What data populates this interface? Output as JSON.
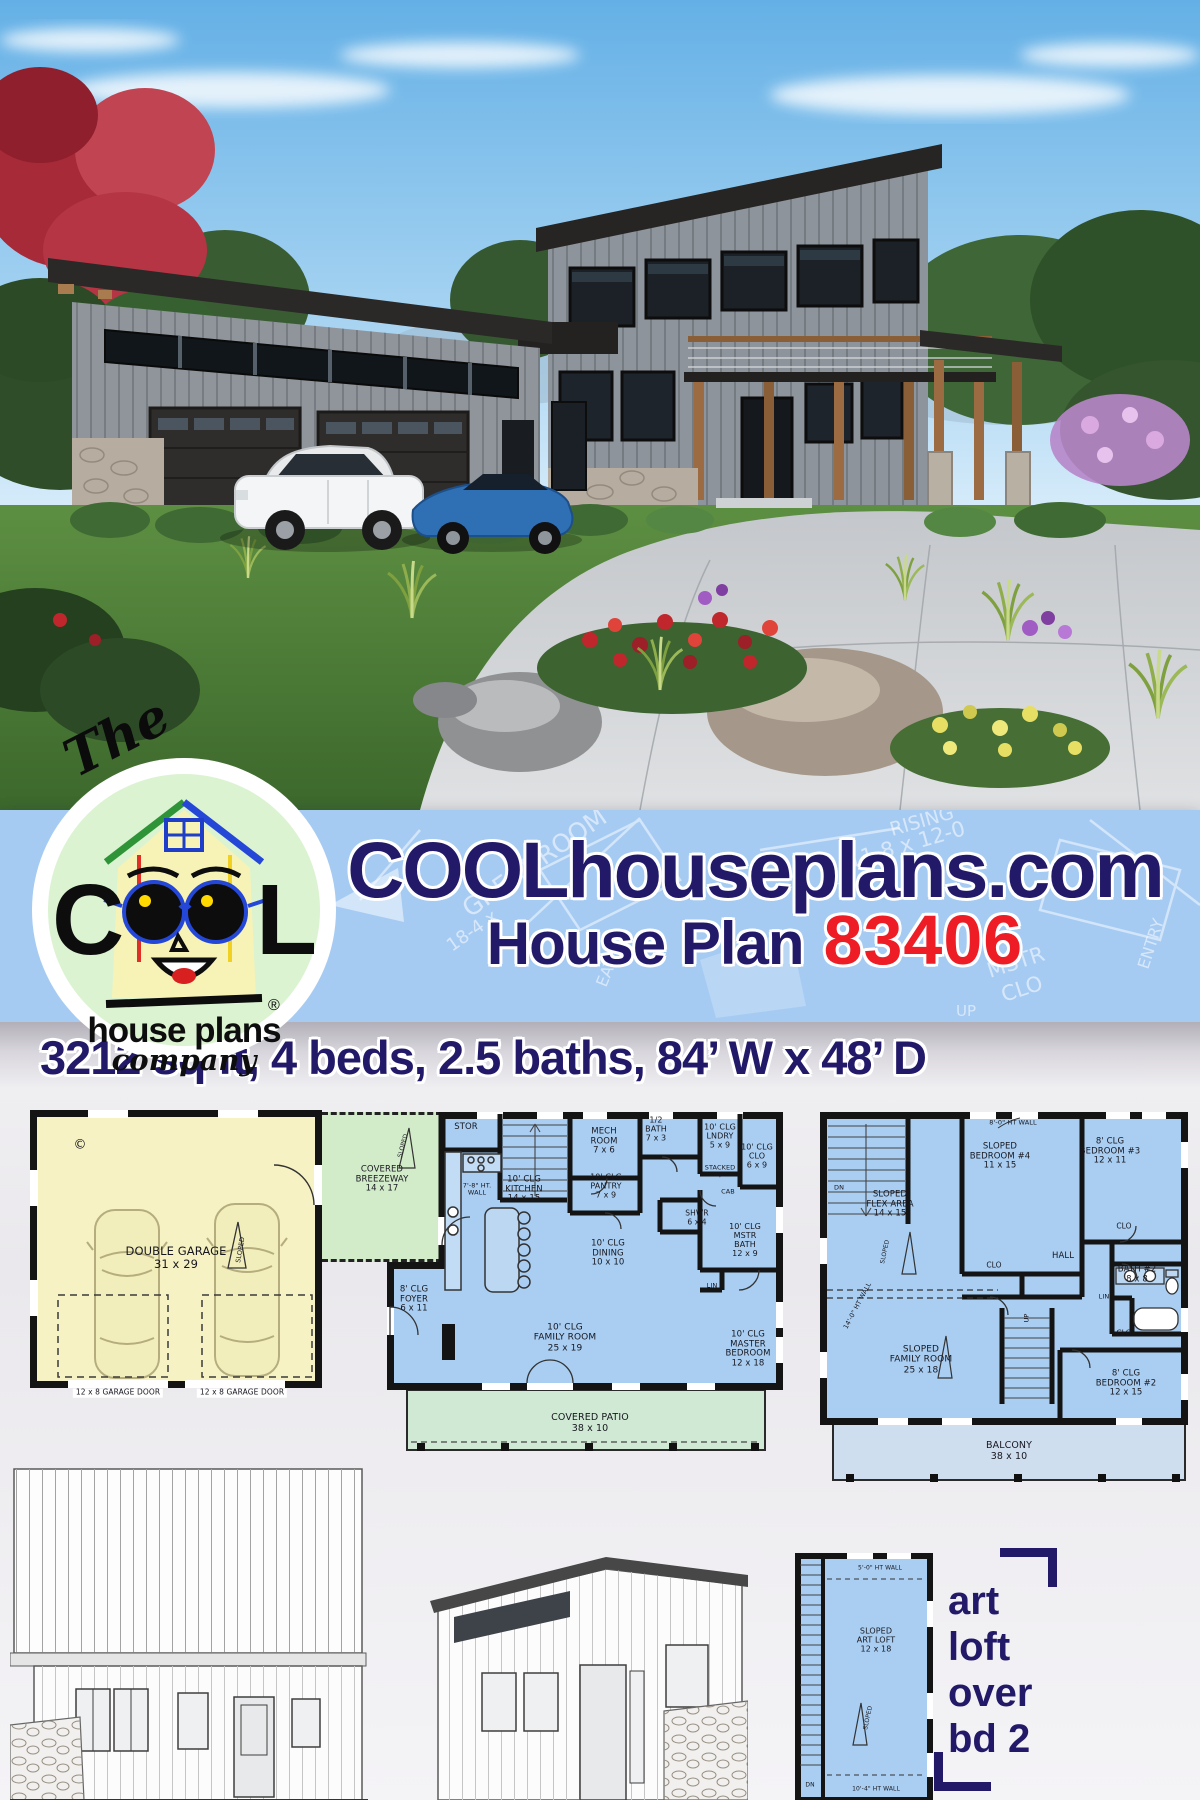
{
  "brand": {
    "the": "The",
    "c": "C",
    "l": "L",
    "house_plans": "house plans",
    "company": "company",
    "reg": "®"
  },
  "header": {
    "site": "COOLhouseplans.com",
    "plan_label": "House Plan",
    "plan_number": "83406"
  },
  "watermark": {
    "dim": "11-8 x 12-0",
    "rising": "RISING",
    "clg": "10' CLG",
    "great_room": "GREAT ROOM",
    "dim2": "18-4 x",
    "eating": "EATING",
    "mstr": "MSTR",
    "clo": "CLO",
    "entry": "ENTRY",
    "up": "UP"
  },
  "specs": "3212 sq ft, 4 beds, 2.5 baths, 84’ W x 48’ D",
  "garage": {
    "copyright": "©",
    "name_dims": "DOUBLE GARAGE\n31 x 29",
    "sloped": "SLOPED",
    "door_left": "12 x 8 GARAGE DOOR",
    "door_right": "12 x 8 GARAGE DOOR"
  },
  "breezeway": {
    "label": "COVERED\nBREEZEWAY\n14 x 17",
    "sloped": "SLOPED"
  },
  "floor1": {
    "stor": "STOR",
    "mech": "MECH\nROOM\n7 x 6",
    "half_bath": "1/2\nBATH\n7 x 3",
    "lndry": "10' CLG\nLNDRY\n5 x 9",
    "stacked": "STACKED\nW/D",
    "clo": "10' CLG\nCLO\n6 x 9",
    "pantry": "10' CLG\nPANTRY\n7 x 9",
    "ht_wall": "7'-8\" HT.\nWALL",
    "kitchen": "10' CLG\nKITCHEN\n14 x 15",
    "dining": "10' CLG\nDINING\n10 x 10",
    "shwr": "SHWR\n6 x 4",
    "mstr_bath": "10' CLG\nMSTR\nBATH\n12 x 9",
    "cab": "CAB",
    "lin": "LIN",
    "foyer": "8' CLG\nFOYER\n6 x 11",
    "family": "10' CLG\nFAMILY ROOM\n25 x 19",
    "master": "10' CLG\nMASTER\nBEDROOM\n12 x 18",
    "patio": "COVERED PATIO\n38 x 10"
  },
  "floor2": {
    "ht_wall_top": "8'-0\" HT WALL",
    "bed4": "SLOPED\nBEDROOM #4\n11 x 15",
    "bed3": "8' CLG\nBEDROOM #3\n12 x 11",
    "flex": "SLOPED\nFLEX AREA\n14 x 15",
    "sloped": "SLOPED",
    "dn": "DN",
    "clo_a": "CLO",
    "hall": "HALL",
    "clo_b": "CLO",
    "bath2": "BATH #2\n8 x 8",
    "lin": "LIN",
    "clo_c": "CLO",
    "family": "SLOPED\nFAMILY ROOM\n25 x 18",
    "up": "UP",
    "ht_wall_side": "14'-0\" HT WALL",
    "bed2": "8' CLG\nBEDROOM #2\n12 x 15",
    "balcony": "BALCONY\n38 x 10"
  },
  "loft": {
    "ht_wall_top": "5'-0\" HT WALL",
    "name": "SLOPED\nART LOFT\n12 x 18",
    "sloped": "SLOPED",
    "ht_wall_bottom": "10'-4\" HT WALL",
    "dn": "DN"
  },
  "tagline": {
    "l1": "art",
    "l2": "loft",
    "l3": "over",
    "l4": "bd 2"
  },
  "colors": {
    "navy": "#221a68",
    "red": "#ee1c25",
    "band_blue": "#a6cbf3",
    "plan_blue": "#a9cef2",
    "garage_yellow": "#f6f2c3",
    "breezeway_green": "#d2ebc9",
    "patio_green": "#cfe9d4",
    "balcony_blue": "#cfdeee",
    "logo_green": "#dbf3d1"
  }
}
